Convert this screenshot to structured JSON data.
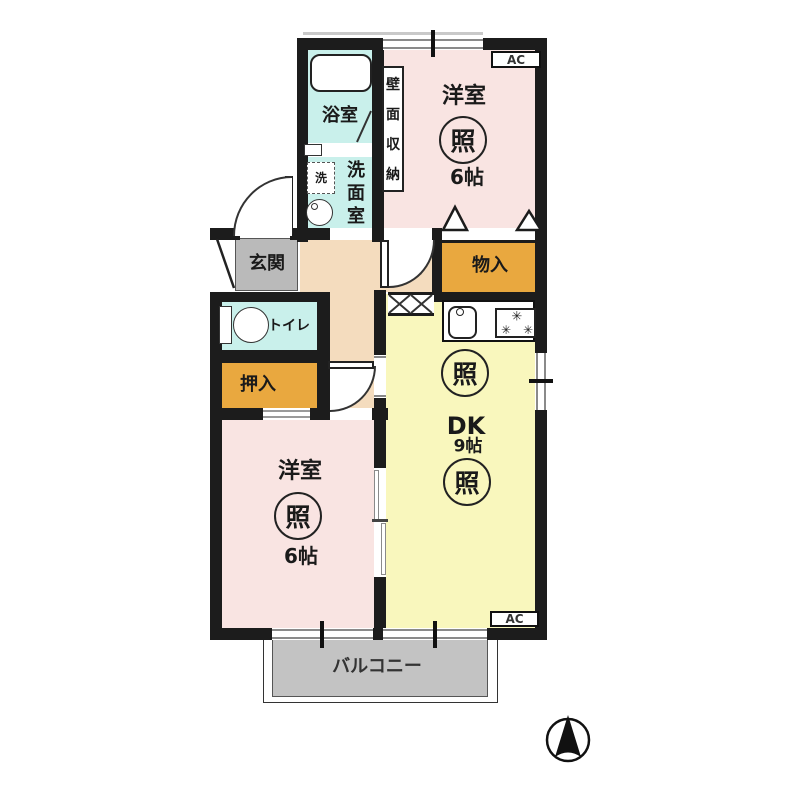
{
  "plan": {
    "rooms": {
      "bath": {
        "label": "浴室"
      },
      "washroom": {
        "chars": [
          "洗",
          "面",
          "室"
        ]
      },
      "wall_storage": {
        "chars": [
          "壁",
          "面",
          "収",
          "納"
        ]
      },
      "laundry": {
        "label": "洗"
      },
      "bedroom_ne": {
        "label": "洋室",
        "size": "6帖"
      },
      "bedroom_sw": {
        "label": "洋室",
        "size": "6帖"
      },
      "dk": {
        "label": "DK",
        "size": "9帖"
      },
      "entrance": {
        "label": "玄関"
      },
      "toilet": {
        "label": "トイレ"
      },
      "closet_south": {
        "label": "押入"
      },
      "closet_north": {
        "label": "物入"
      },
      "balcony": {
        "label": "バルコニー"
      }
    },
    "symbols": {
      "light": "照",
      "ac": "AC",
      "burner": "✳"
    },
    "colors": {
      "wall": "#1c1c1c",
      "room_pink": "#f9e4e2",
      "wet_cyan": "#c9f0eb",
      "dk_yellow": "#f9f7bd",
      "closet_orange": "#e9a83f",
      "hall_beige": "#f4dcbe",
      "entrance_gray": "#bababa",
      "balcony_gray": "#c3c3c3"
    }
  }
}
